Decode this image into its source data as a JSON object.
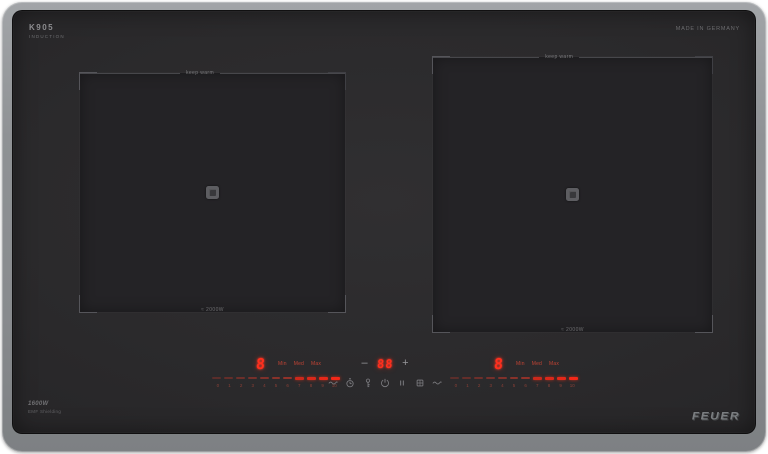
{
  "branding": {
    "model_mark": {
      "line1": "K905",
      "line2": "INDUCTION"
    },
    "made_in": "MADE IN GERMANY",
    "brand_logo": "FEUER",
    "front_label": {
      "line1": "1600W",
      "line2": "EMF Shielding"
    }
  },
  "zones": {
    "left": {
      "top_label": "keep warm",
      "bottom_label": "≈ 2000W"
    },
    "right": {
      "top_label": "keep warm",
      "bottom_label": "≈ 2000W"
    }
  },
  "controls": {
    "left_zone_display": "8",
    "right_zone_display": "8",
    "power_scale": {
      "labels": [
        "Min",
        "Med",
        "Max"
      ],
      "levels": [
        "0",
        "1",
        "2",
        "3",
        "4",
        "5",
        "6",
        "7",
        "8",
        "9",
        "10"
      ]
    },
    "timer": {
      "minus": "–",
      "value": "88",
      "plus": "+"
    },
    "center_icons": [
      {
        "name": "keep-warm-icon",
        "shape": "wave"
      },
      {
        "name": "timer-icon",
        "shape": "clock"
      },
      {
        "name": "child-lock-icon",
        "shape": "key"
      },
      {
        "name": "power-icon",
        "shape": "power"
      },
      {
        "name": "pause-icon",
        "shape": "pause"
      },
      {
        "name": "boost-icon",
        "shape": "boost"
      },
      {
        "name": "keep-warm-right-icon",
        "shape": "wave"
      }
    ]
  },
  "colors": {
    "led": "#ff2f1d",
    "led_dim": "#8c4036",
    "frame": "#8f9295",
    "glass": "#2b2a2c",
    "label_text": "#7a7a7d"
  }
}
